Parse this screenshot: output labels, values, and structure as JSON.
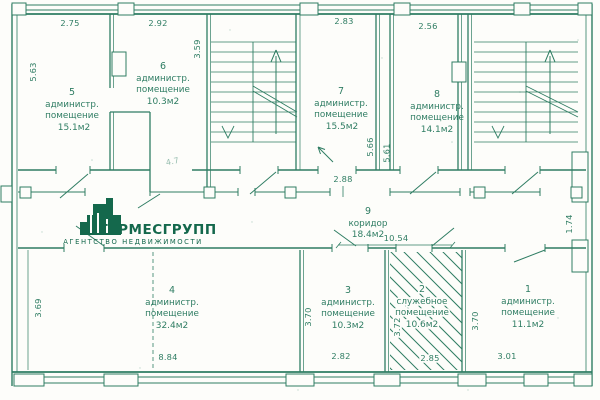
{
  "colors": {
    "line": "#2f7d63",
    "logo": "#14684c",
    "background": "#fdfdfa"
  },
  "logo": {
    "title": "ГЕРМЕСГРУПП",
    "subtitle": "АГЕНТСТВО НЕДВИЖИМОСТИ"
  },
  "rooms": {
    "r1": {
      "num": "1",
      "name1": "администр.",
      "name2": "помещение",
      "area": "11.1м2"
    },
    "r2": {
      "num": "2",
      "name1": "служебное",
      "name2": "помещение",
      "area": "10.6м2"
    },
    "r3": {
      "num": "3",
      "name1": "администр.",
      "name2": "помещение",
      "area": "10.3м2"
    },
    "r4": {
      "num": "4",
      "name1": "администр.",
      "name2": "помещение",
      "area": "32.4м2"
    },
    "r5": {
      "num": "5",
      "name1": "администр.",
      "name2": "помещение",
      "area": "15.1м2"
    },
    "r6": {
      "num": "6",
      "name1": "администр.",
      "name2": "помещение",
      "area": "10.3м2"
    },
    "r7": {
      "num": "7",
      "name1": "администр.",
      "name2": "помещение",
      "area": "15.5м2"
    },
    "r8": {
      "num": "8",
      "name1": "администр.",
      "name2": "помещение",
      "area": "14.1м2"
    },
    "r9": {
      "num": "9",
      "name1": "коридор",
      "area": "18.4м2"
    }
  },
  "dimensions": {
    "room5_top": "2.75",
    "room6_top": "2.92",
    "room7_top": "2.83",
    "room8_top": "2.56",
    "room5_left": "5.63",
    "room6_right": "3.59",
    "room7_right": "5.66",
    "room8_left": "5.61",
    "corridor_width": "2.88",
    "corridor_length": "10.54",
    "hall_area": "4.7",
    "corridor_right": "1.74",
    "room4_left": "3.69",
    "room3_left": "3.70",
    "room2_left": "3.72",
    "room1_left": "3.70",
    "room4_bottom": "8.84",
    "room3_bottom": "2.82",
    "room2_bottom": "2.85",
    "room1_bottom": "3.01"
  }
}
